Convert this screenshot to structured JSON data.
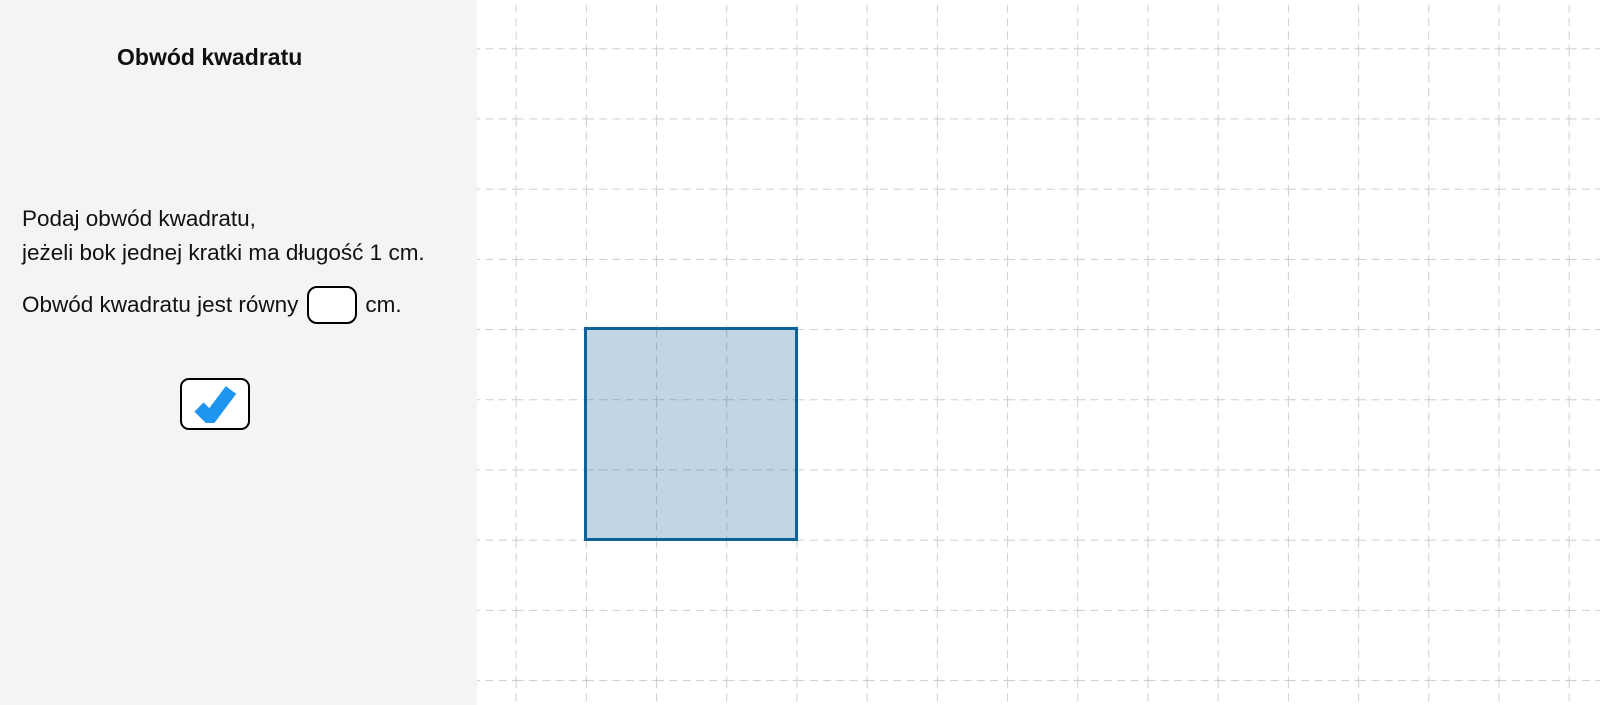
{
  "window": {
    "width_px": 1600,
    "height_px": 705
  },
  "panel": {
    "title": "Obwód kwadratu",
    "instructions": [
      "Podaj obwód kwadratu,",
      "jeżeli bok jednej kratki ma długość 1 cm."
    ],
    "answer": {
      "prefix": "Obwód kwadratu jest równy",
      "suffix": "cm.",
      "input_value": "",
      "input_placeholder": ""
    },
    "check_button": {
      "icon": "check-icon",
      "icon_color": "#1E96F0"
    }
  },
  "canvas": {
    "grid": {
      "style": "dashed",
      "line_color": "#C7C7C7",
      "cell_represents": "1 cm"
    },
    "square": {
      "side_cells": 3,
      "stroke_color": "#0E6298",
      "fill_color": "rgba(14,98,152,0.26)"
    }
  },
  "colors": {
    "panel_bg": "#F4F4F4",
    "canvas_bg": "#FFFFFF"
  }
}
